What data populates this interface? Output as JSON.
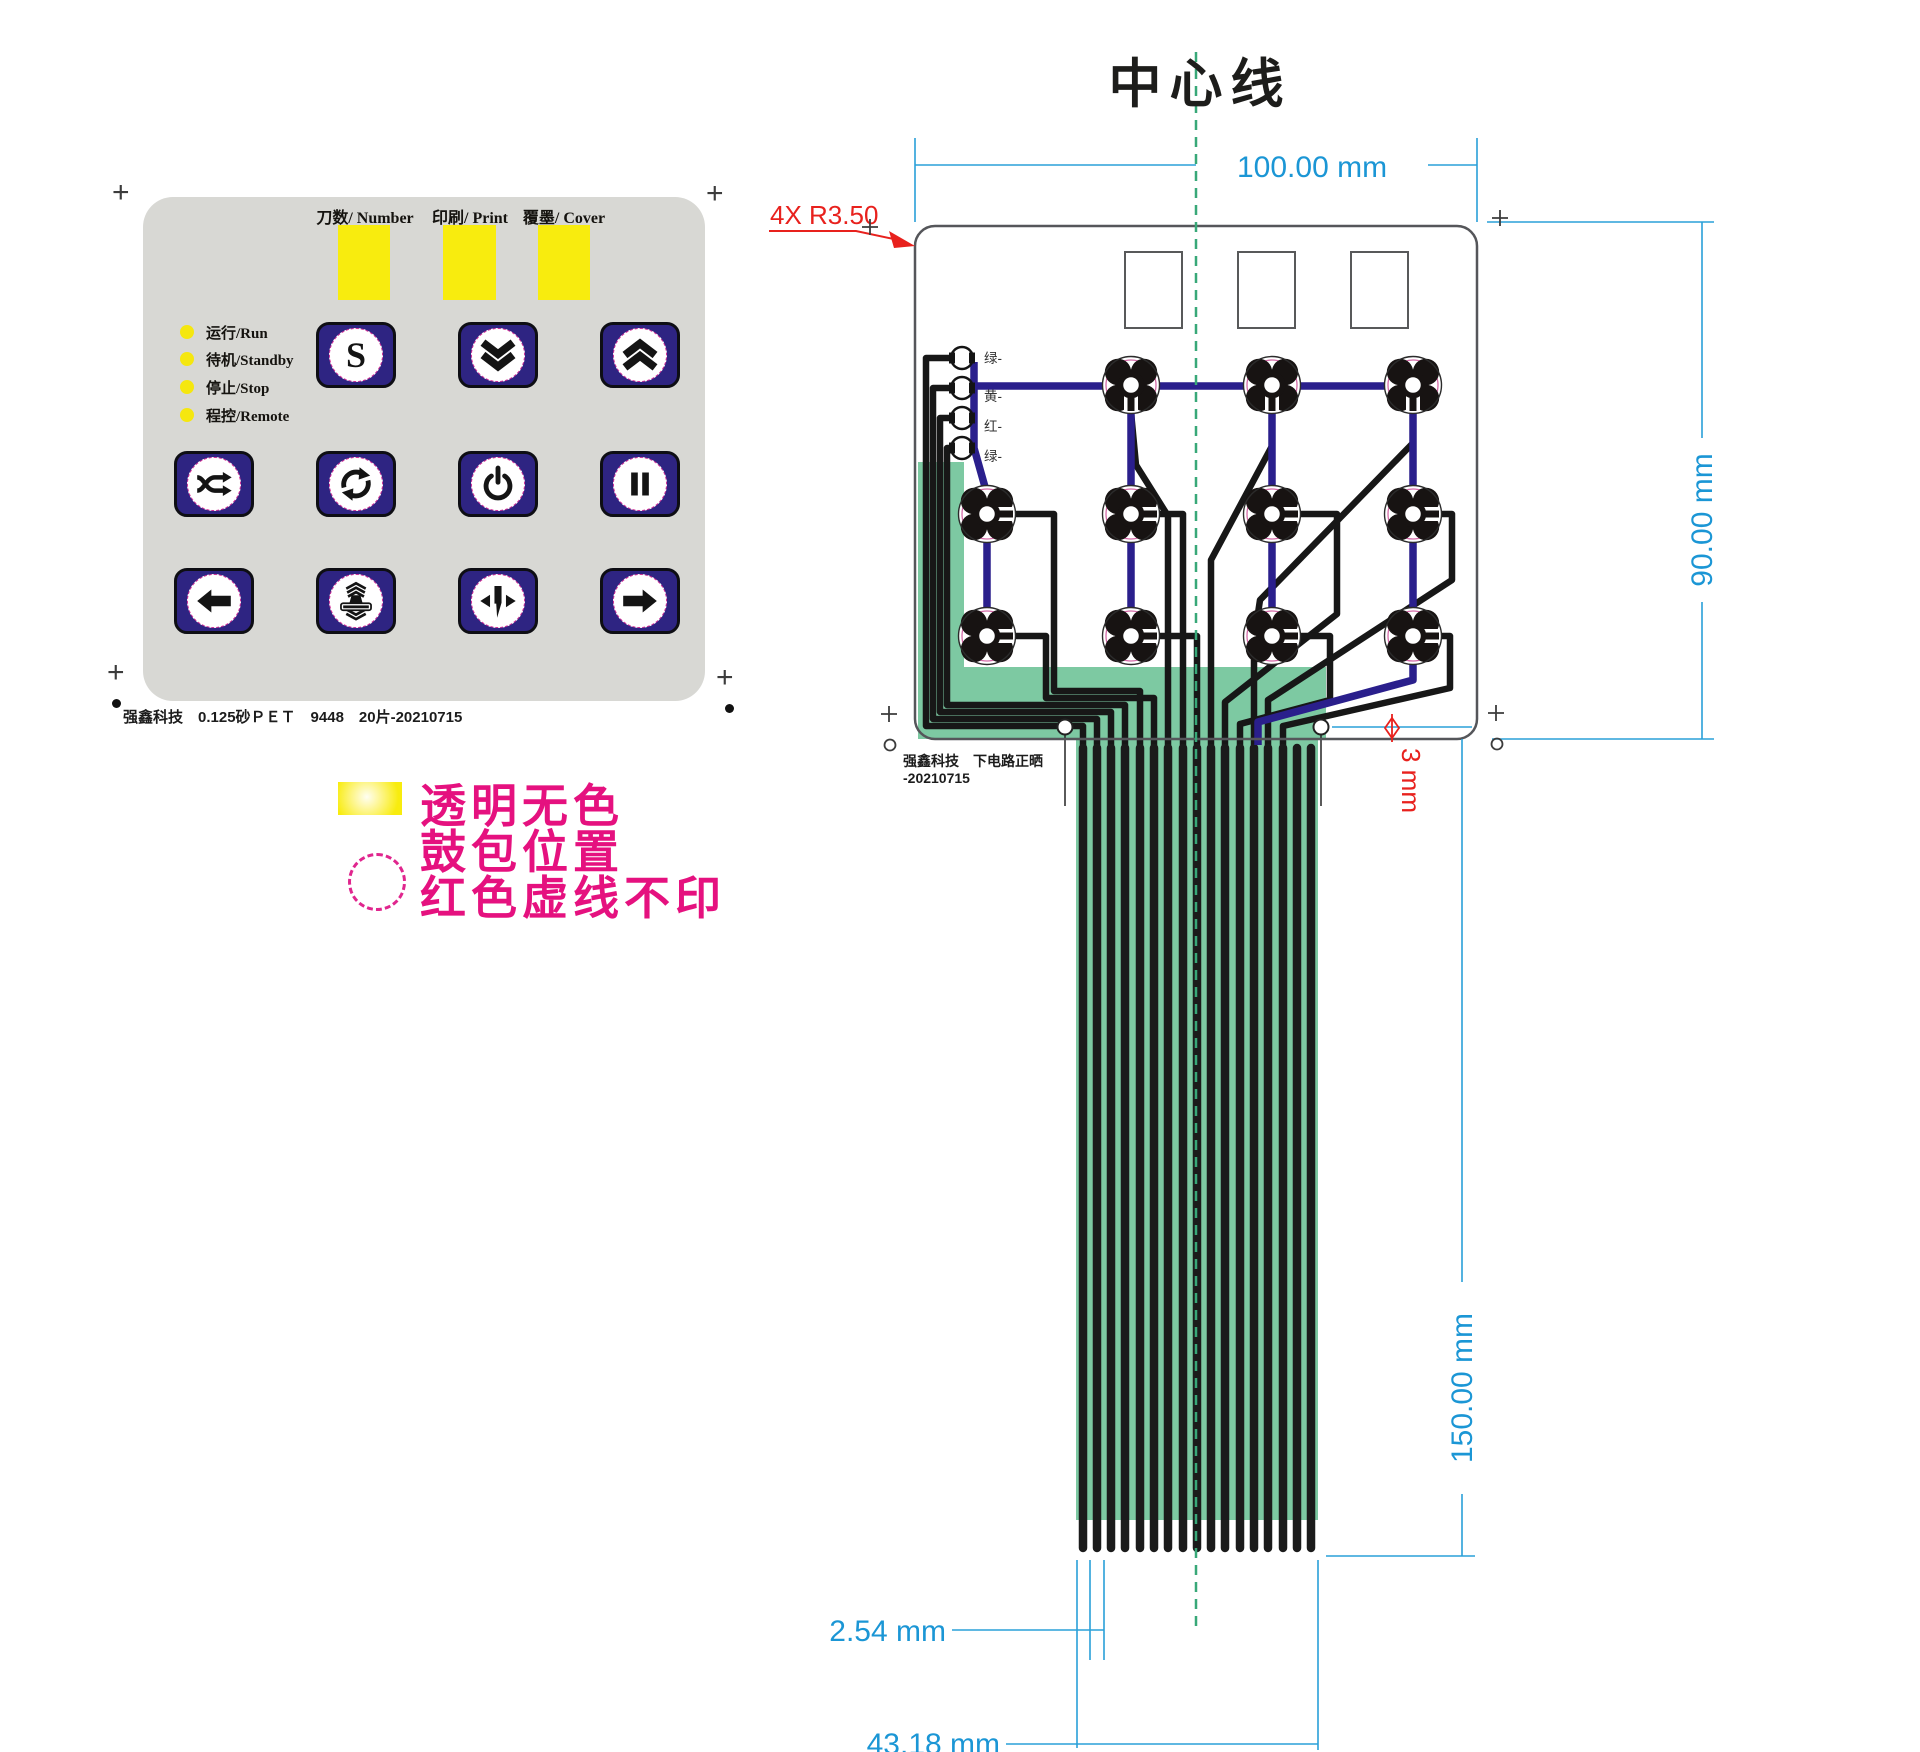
{
  "keypad": {
    "windows": [
      {
        "label": "刀数/ Number"
      },
      {
        "label": "印刷/ Print"
      },
      {
        "label": "覆墨/ Cover"
      }
    ],
    "leds": [
      {
        "label": "运行/Run"
      },
      {
        "label": "待机/Standby"
      },
      {
        "label": "停止/Stop"
      },
      {
        "label": "程控/Remote"
      }
    ],
    "buttons": [
      {
        "icon": "s-button",
        "label": "S",
        "row": 1,
        "col": 2
      },
      {
        "icon": "chevrons-down",
        "row": 1,
        "col": 3
      },
      {
        "icon": "chevrons-up",
        "row": 1,
        "col": 4
      },
      {
        "icon": "shuffle",
        "row": 2,
        "col": 1
      },
      {
        "icon": "cycle",
        "row": 2,
        "col": 2
      },
      {
        "icon": "power",
        "row": 2,
        "col": 3
      },
      {
        "icon": "pause",
        "row": 2,
        "col": 4
      },
      {
        "icon": "arrow-left",
        "row": 3,
        "col": 1
      },
      {
        "icon": "press",
        "row": 3,
        "col": 2
      },
      {
        "icon": "split",
        "row": 3,
        "col": 3
      },
      {
        "icon": "arrow-right",
        "row": 3,
        "col": 4
      }
    ],
    "footer": "强鑫科技　0.125砂ＰＥＴ　9448　20片-20210715"
  },
  "legend": {
    "lines": [
      "透明无色",
      "鼓包位置",
      "红色虚线不印"
    ]
  },
  "drawing": {
    "title": "中心线",
    "corner_note": "4X R3.50",
    "led_labels": [
      "绿-",
      "黄-",
      "红-",
      "绿-"
    ],
    "note_line1": "强鑫科技　下电路正晒",
    "note_line2": "-20210715",
    "dimensions": {
      "board_width": "100.00 mm",
      "board_height": "90.00 mm",
      "tail_length": "150.00 mm",
      "finger_pitch": "2.54 mm",
      "tail_width": "43.18 mm",
      "hole_diameter": "3 mm"
    },
    "colors": {
      "dimension_blue": "#1b96d5",
      "annotation_red": "#e8211d",
      "coverlay_green": "#7dc9a2",
      "trace_blue": "#2a1f8c",
      "trace_black": "#171717",
      "center_line_green": "#38a878",
      "legend_magenta": "#e5117f",
      "key_navy": "#2e2482",
      "window_yellow": "#f8ec0e",
      "panel_gray": "#d8d8d4"
    }
  }
}
